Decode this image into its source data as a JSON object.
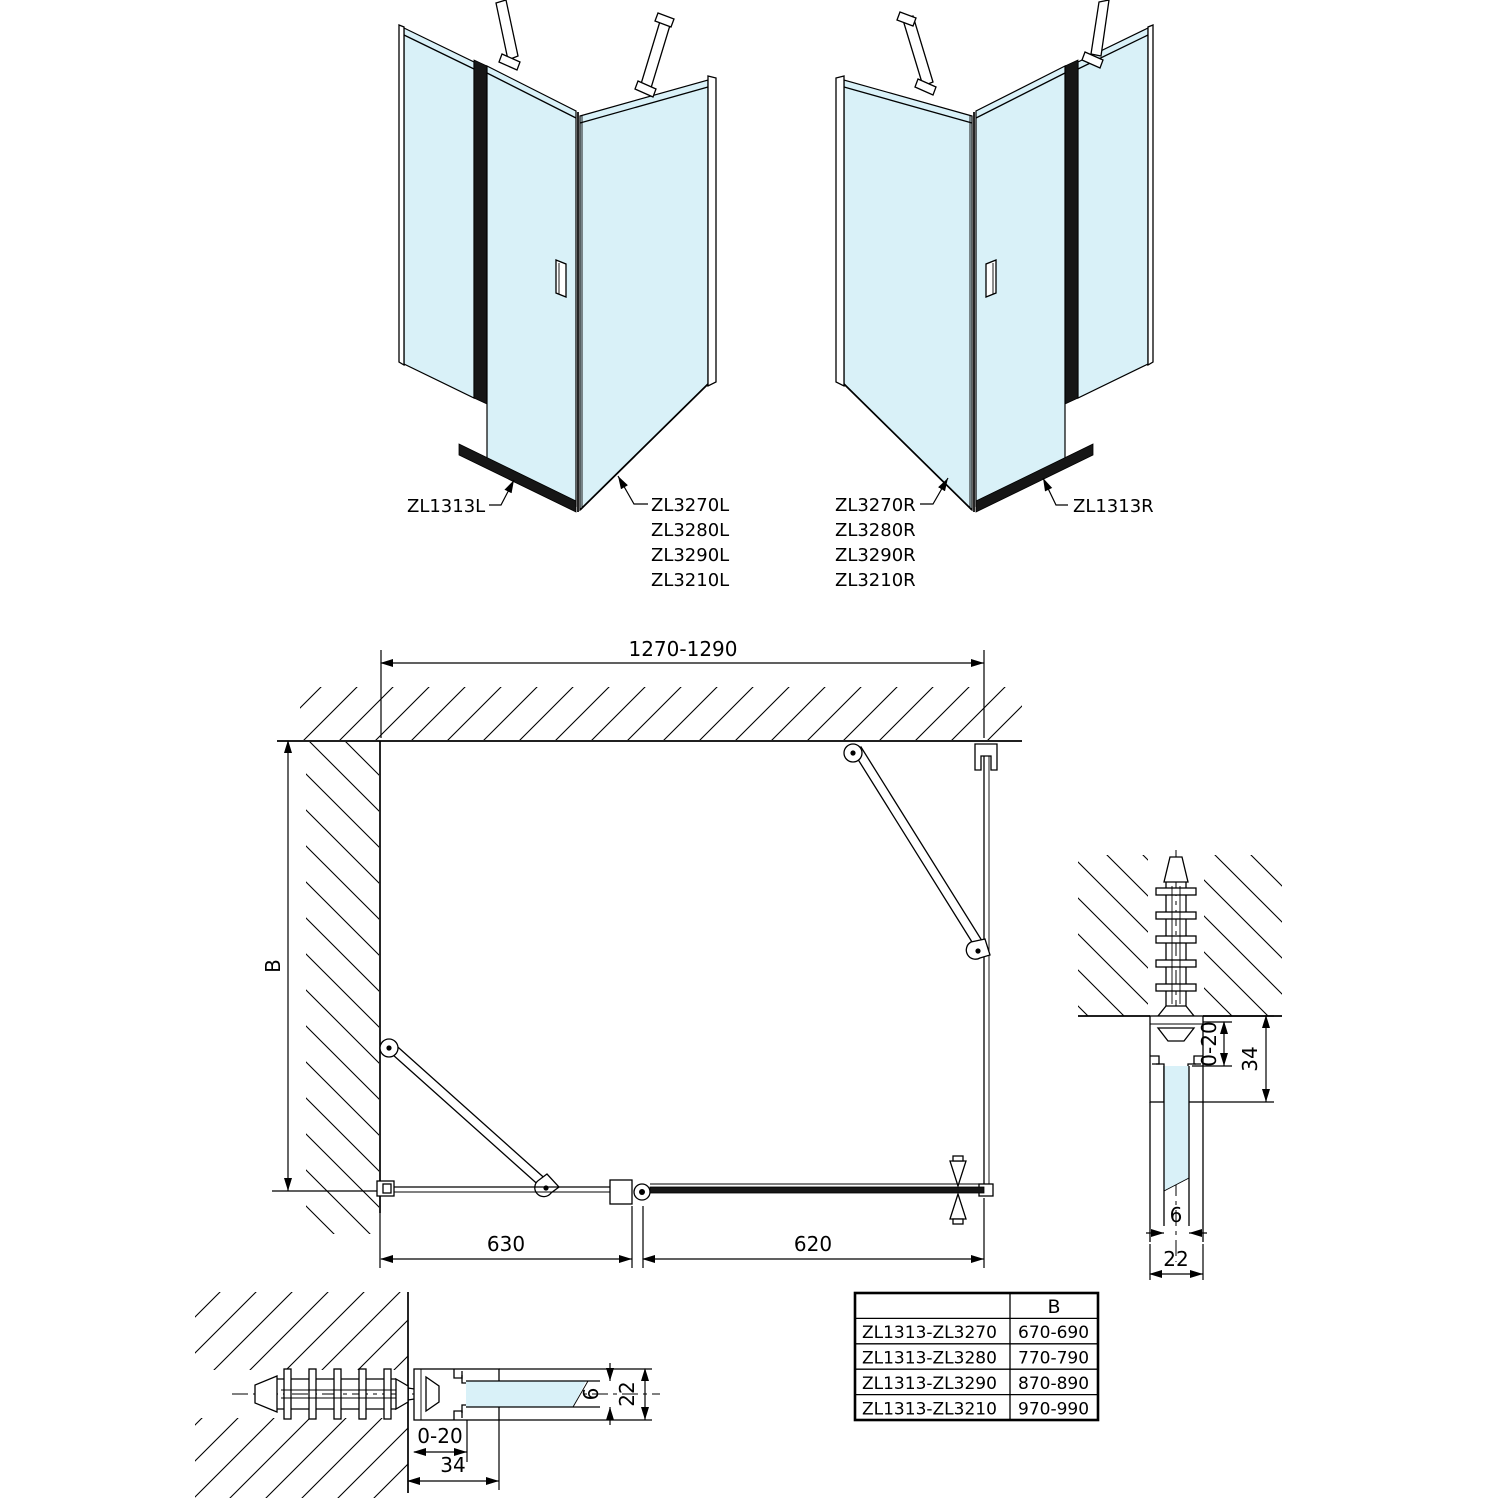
{
  "drawing": {
    "left_view": {
      "panel_label": "ZL1313L",
      "door_labels": [
        "ZL3270L",
        "ZL3280L",
        "ZL3290L",
        "ZL3210L"
      ]
    },
    "right_view": {
      "door_labels": [
        "ZL3270R",
        "ZL3280R",
        "ZL3290R",
        "ZL3210R"
      ],
      "panel_label": "ZL1313R"
    },
    "plan": {
      "width_range": "1270-1290",
      "depth_label": "B",
      "left_segment": "630",
      "right_segment": "620"
    },
    "detail_right": {
      "adjustment": "0-20",
      "profile_depth": "34",
      "glass_thickness": "6",
      "profile_width": "22"
    },
    "detail_bottom": {
      "adjustment": "0-20",
      "profile_depth": "34",
      "glass_thickness": "6",
      "profile_width": "22"
    },
    "size_table": {
      "col_header": "B",
      "rows": [
        {
          "models": "ZL1313-ZL3270",
          "b_range": "670-690"
        },
        {
          "models": "ZL1313-ZL3280",
          "b_range": "770-790"
        },
        {
          "models": "ZL1313-ZL3290",
          "b_range": "870-890"
        },
        {
          "models": "ZL1313-ZL3210",
          "b_range": "970-990"
        }
      ]
    },
    "colors": {
      "glass": "#d9f1f8",
      "line": "#000000",
      "profile_dark": "#161616"
    }
  }
}
